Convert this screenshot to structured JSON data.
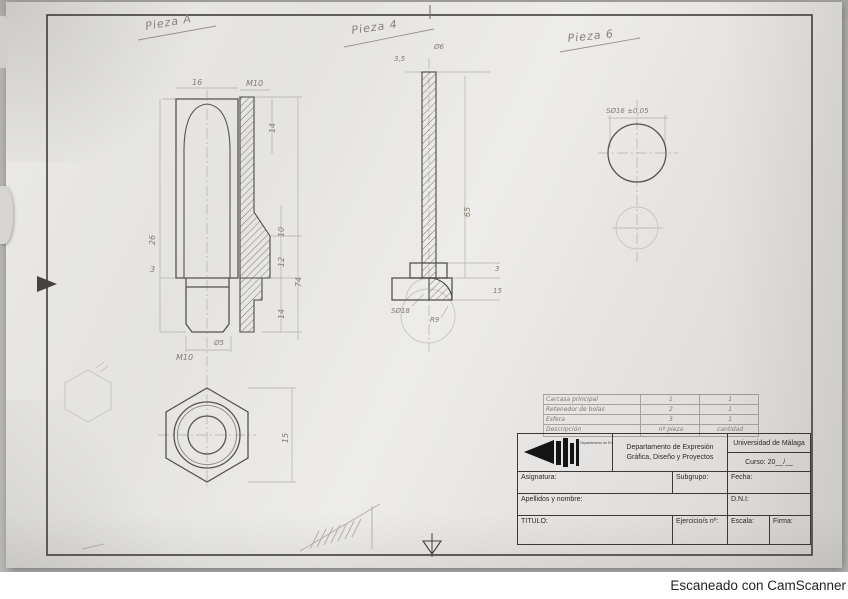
{
  "watermark": "Escaneado con CamScanner",
  "pieces": {
    "a": {
      "label": "Pieza A",
      "dims": {
        "width_top": "16",
        "thread_top": "M10",
        "depth_top": "14",
        "len_26": "26",
        "step_3": "3",
        "d10": "10",
        "d12": "12",
        "d14": "14",
        "total_74": "74",
        "thread_bottom": "M10",
        "bore": "Ø5",
        "hex_15": "15"
      }
    },
    "b": {
      "label": "Pieza 4",
      "dims": {
        "top_35": "3,5",
        "dia_6": "Ø6",
        "len_65": "65",
        "sphere": "SØ18",
        "radius": "R9",
        "step_3": "3",
        "step_15": "15"
      }
    },
    "c": {
      "label": "Pieza 6",
      "dims": {
        "sphere": "SØ16 ±0,05"
      }
    }
  },
  "parts_table": {
    "header": [
      "Descripción",
      "nº pieza",
      "cantidad"
    ],
    "rows": [
      [
        "Carcasa principal",
        "1",
        "1"
      ],
      [
        "Retenedor de bolas",
        "2",
        "1"
      ],
      [
        "Esfera",
        "3",
        "1"
      ]
    ]
  },
  "title_block": {
    "department_line1": "Departamento de Expresión",
    "department_line2": "Gráfica, Diseño y Proyectos",
    "university": "Universidad de Málaga",
    "curso": "Curso: 20__/__",
    "asignatura": "Asignatura:",
    "subgrupo": "Subgrupo:",
    "fecha": "Fecha:",
    "apellidos": "Apellidos y nombre:",
    "dni": "D.N.I:",
    "titulo": "TITULO:",
    "ejercicio": "Ejercicio/s nº:",
    "escala": "Escala:",
    "firma": "Firma:",
    "logo_text": "Departamento de Expresión Gráfica, Diseño y Proyectos"
  }
}
